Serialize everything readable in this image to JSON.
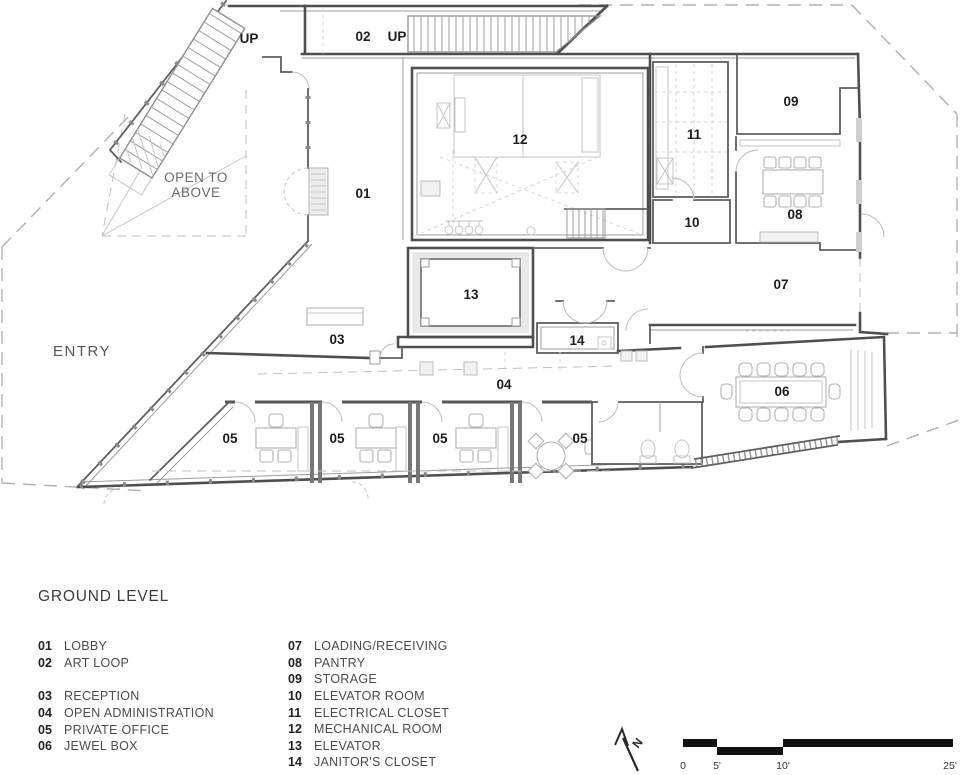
{
  "sheet": {
    "title": "GROUND LEVEL"
  },
  "plan_labels": {
    "up_stair_left": "UP",
    "art_loop_number": "02",
    "up_stair_top": "UP",
    "lobby": "01",
    "reception": "03",
    "open_admin": "04",
    "private_office": "05",
    "jewel_box": "06",
    "loading": "07",
    "pantry": "08",
    "storage": "09",
    "elevator_room": "10",
    "electrical": "11",
    "mechanical": "12",
    "elevator": "13",
    "janitor": "14",
    "entry": "ENTRY",
    "open_to_above_line1": "OPEN TO",
    "open_to_above_line2": "ABOVE"
  },
  "legend": {
    "left": [
      {
        "num": "01",
        "label": "LOBBY"
      },
      {
        "num": "02",
        "label": "ART LOOP"
      },
      {
        "num": "03",
        "label": "RECEPTION"
      },
      {
        "num": "04",
        "label": "OPEN ADMINISTRATION"
      },
      {
        "num": "05",
        "label": "PRIVATE OFFICE"
      },
      {
        "num": "06",
        "label": "JEWEL BOX"
      }
    ],
    "right": [
      {
        "num": "07",
        "label": "LOADING/RECEIVING"
      },
      {
        "num": "08",
        "label": "PANTRY"
      },
      {
        "num": "09",
        "label": "STORAGE"
      },
      {
        "num": "10",
        "label": "ELEVATOR ROOM"
      },
      {
        "num": "11",
        "label": "ELECTRICAL CLOSET"
      },
      {
        "num": "12",
        "label": "MECHANICAL ROOM"
      },
      {
        "num": "13",
        "label": "ELEVATOR"
      },
      {
        "num": "14",
        "label": "JANITOR'S CLOSET"
      }
    ]
  },
  "north": {
    "label": "N"
  },
  "scale_bar": {
    "ticks": [
      "0",
      "5'",
      "10'",
      "25'"
    ]
  }
}
